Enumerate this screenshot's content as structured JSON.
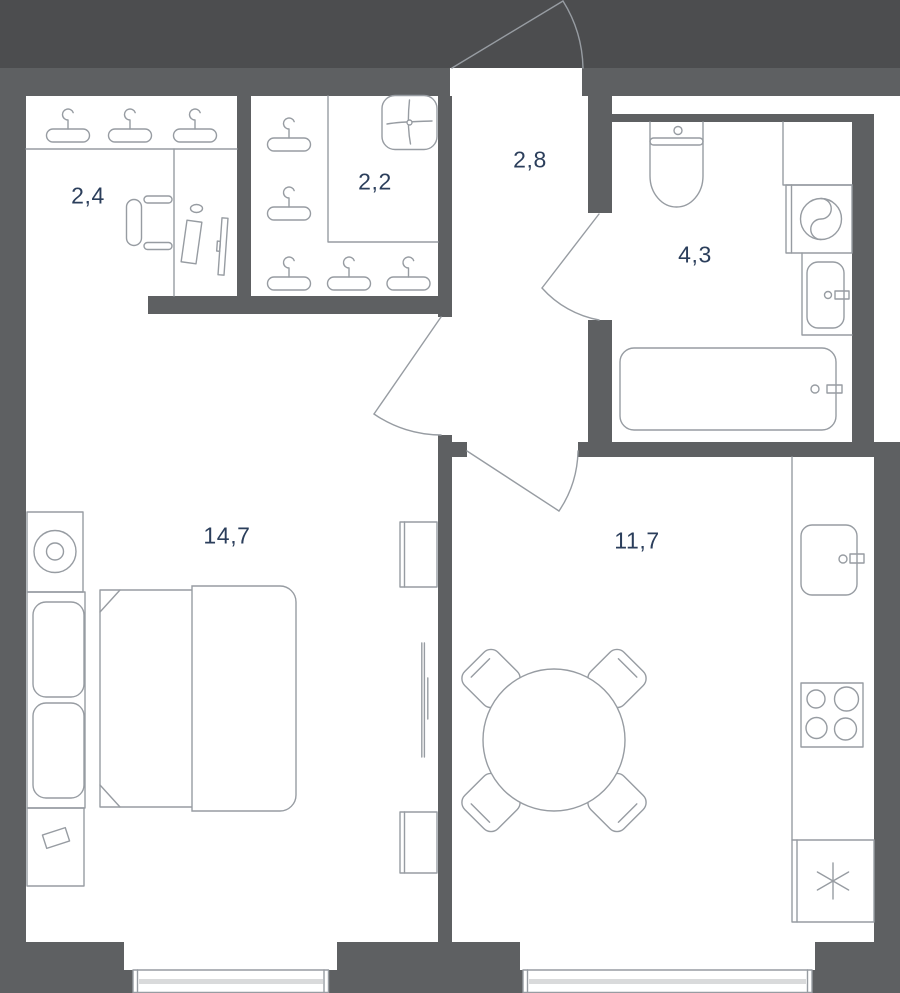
{
  "title": "apartment-floor-plan",
  "rooms": {
    "walk_in_closet": {
      "area": "2,4"
    },
    "closet": {
      "area": "2,2"
    },
    "hallway": {
      "area": "2,8"
    },
    "bathroom": {
      "area": "4,3"
    },
    "bedroom": {
      "area": "14,7"
    },
    "kitchen_living": {
      "area": "11,7"
    }
  },
  "colors": {
    "background": "#4c4d4f",
    "wall": "#5e6062",
    "floor": "#ffffff",
    "line": "#979ca2",
    "label": "#2b3e5b",
    "window_bar": "#d9dadb"
  }
}
